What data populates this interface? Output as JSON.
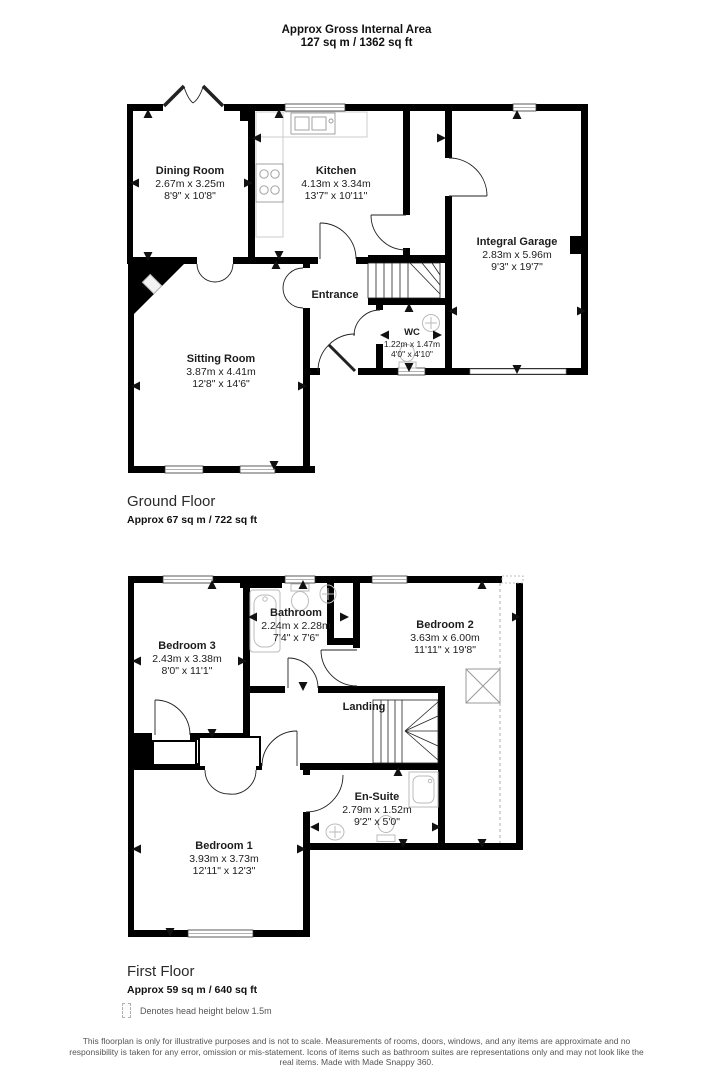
{
  "header": {
    "title": "Approx Gross Internal Area",
    "subtitle": "127 sq m / 1362 sq ft"
  },
  "ground_floor": {
    "title": "Ground Floor",
    "area": "Approx 67 sq m / 722 sq ft",
    "rooms": {
      "dining": {
        "name": "Dining Room",
        "metric": "2.67m x 3.25m",
        "imperial": "8'9\" x 10'8\""
      },
      "kitchen": {
        "name": "Kitchen",
        "metric": "4.13m x 3.34m",
        "imperial": "13'7\" x 10'11\""
      },
      "garage": {
        "name": "Integral Garage",
        "metric": "2.83m x 5.96m",
        "imperial": "9'3\" x 19'7\""
      },
      "entrance": {
        "name": "Entrance"
      },
      "wc": {
        "name": "WC",
        "metric": "1.22m x 1.47m",
        "imperial": "4'0\" x 4'10\""
      },
      "sitting": {
        "name": "Sitting Room",
        "metric": "3.87m x 4.41m",
        "imperial": "12'8\" x 14'6\""
      }
    }
  },
  "first_floor": {
    "title": "First Floor",
    "area": "Approx 59 sq m / 640 sq ft",
    "rooms": {
      "bedroom3": {
        "name": "Bedroom 3",
        "metric": "2.43m x 3.38m",
        "imperial": "8'0\" x 11'1\""
      },
      "bathroom": {
        "name": "Bathroom",
        "metric": "2.24m x 2.28m",
        "imperial": "7'4\" x 7'6\""
      },
      "bedroom2": {
        "name": "Bedroom 2",
        "metric": "3.63m x 6.00m",
        "imperial": "11'11\" x 19'8\""
      },
      "landing": {
        "name": "Landing"
      },
      "ensuite": {
        "name": "En-Suite",
        "metric": "2.79m x 1.52m",
        "imperial": "9'2\" x 5'0\""
      },
      "bedroom1": {
        "name": "Bedroom 1",
        "metric": "3.93m x 3.73m",
        "imperial": "12'11\" x 12'3\""
      }
    }
  },
  "legend": {
    "label": "Denotes head height below 1.5m"
  },
  "footer": {
    "disclaimer": "This floorplan is only for illustrative purposes and is not to scale. Measurements of rooms, doors, windows, and any items are approximate and no responsibility is taken for any error, omission or mis-statement. Icons of items such as bathroom suites are representations only and may not look like the real items. Made with Made Snappy 360."
  },
  "colors": {
    "wall": "#000000",
    "fixture": "#c4c4c4",
    "text": "#1c1c1c",
    "footer_text": "#555555"
  }
}
